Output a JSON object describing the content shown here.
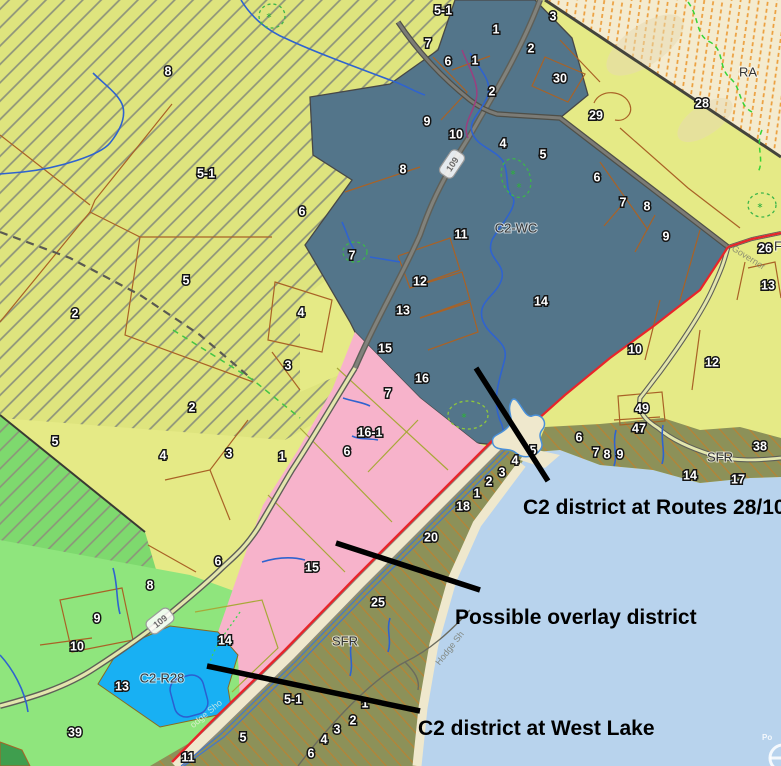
{
  "map": {
    "colors": {
      "yellow_flat": "#e5ea86",
      "yellow_hatch_bg": "#dee47e",
      "hatch_gray": "#8d937b",
      "slate": "#53758a",
      "pink": "#f7b3cb",
      "olive": "#8c9159",
      "olive_hatch": "#c07f2c",
      "ra_bg": "#f4ebcf",
      "ra_hatch": "#ec9f3d",
      "lake": "#b8d3ed",
      "cyan": "#18b0f3",
      "light_green": "#8fe57d",
      "green_hatch_bg": "#7ed96e",
      "sand": "#efe8cd",
      "road_red": "#e8252a",
      "stream_blue": "#2f63cf",
      "parcel_line": "#a96226",
      "pink_parcel_line": "#a8a838",
      "dark_green": "#3f9e4e",
      "annotation_black": "#000000"
    },
    "zone_labels": [
      {
        "t": "C2-WC",
        "x": 516,
        "y": 228,
        "s": 13
      },
      {
        "t": "RA",
        "x": 748,
        "y": 72,
        "s": 14
      },
      {
        "t": "SFR",
        "x": 345,
        "y": 641,
        "s": 13
      },
      {
        "t": "SFR",
        "x": 720,
        "y": 457,
        "s": 13
      },
      {
        "t": "C2-R28",
        "x": 162,
        "y": 678,
        "s": 13
      },
      {
        "t": "F",
        "x": 778,
        "y": 246,
        "s": 13
      }
    ],
    "parcel_labels": [
      {
        "t": "8",
        "x": 168,
        "y": 71
      },
      {
        "t": "5-1",
        "x": 443,
        "y": 10
      },
      {
        "t": "7",
        "x": 428,
        "y": 43
      },
      {
        "t": "3",
        "x": 553,
        "y": 16
      },
      {
        "t": "1",
        "x": 496,
        "y": 29
      },
      {
        "t": "2",
        "x": 531,
        "y": 48
      },
      {
        "t": "1",
        "x": 475,
        "y": 60
      },
      {
        "t": "6",
        "x": 448,
        "y": 61
      },
      {
        "t": "2",
        "x": 492,
        "y": 91
      },
      {
        "t": "30",
        "x": 560,
        "y": 78
      },
      {
        "t": "29",
        "x": 596,
        "y": 115
      },
      {
        "t": "28",
        "x": 702,
        "y": 103
      },
      {
        "t": "9",
        "x": 427,
        "y": 121
      },
      {
        "t": "10",
        "x": 456,
        "y": 134
      },
      {
        "t": "4",
        "x": 503,
        "y": 143
      },
      {
        "t": "5",
        "x": 543,
        "y": 154
      },
      {
        "t": "8",
        "x": 403,
        "y": 169
      },
      {
        "t": "6",
        "x": 597,
        "y": 177
      },
      {
        "t": "7",
        "x": 623,
        "y": 202
      },
      {
        "t": "8",
        "x": 647,
        "y": 206
      },
      {
        "t": "9",
        "x": 666,
        "y": 236
      },
      {
        "t": "11",
        "x": 461,
        "y": 234
      },
      {
        "t": "12",
        "x": 420,
        "y": 281
      },
      {
        "t": "13",
        "x": 403,
        "y": 310
      },
      {
        "t": "14",
        "x": 541,
        "y": 301
      },
      {
        "t": "15",
        "x": 385,
        "y": 348
      },
      {
        "t": "16",
        "x": 422,
        "y": 378
      },
      {
        "t": "5-1",
        "x": 206,
        "y": 173
      },
      {
        "t": "6",
        "x": 302,
        "y": 211
      },
      {
        "t": "7",
        "x": 352,
        "y": 255
      },
      {
        "t": "5",
        "x": 186,
        "y": 280
      },
      {
        "t": "2",
        "x": 75,
        "y": 313
      },
      {
        "t": "4",
        "x": 301,
        "y": 312
      },
      {
        "t": "3",
        "x": 288,
        "y": 365
      },
      {
        "t": "26",
        "x": 765,
        "y": 248
      },
      {
        "t": "13",
        "x": 768,
        "y": 285
      },
      {
        "t": "10",
        "x": 635,
        "y": 349
      },
      {
        "t": "12",
        "x": 712,
        "y": 362
      },
      {
        "t": "49",
        "x": 642,
        "y": 408
      },
      {
        "t": "47",
        "x": 639,
        "y": 428
      },
      {
        "t": "38",
        "x": 760,
        "y": 446
      },
      {
        "t": "14",
        "x": 690,
        "y": 475
      },
      {
        "t": "17",
        "x": 738,
        "y": 479
      },
      {
        "t": "6",
        "x": 579,
        "y": 437
      },
      {
        "t": "7",
        "x": 596,
        "y": 452
      },
      {
        "t": "8",
        "x": 607,
        "y": 454
      },
      {
        "t": "9",
        "x": 620,
        "y": 454
      },
      {
        "t": "5",
        "x": 533,
        "y": 450
      },
      {
        "t": "4",
        "x": 515,
        "y": 460
      },
      {
        "t": "3",
        "x": 502,
        "y": 472
      },
      {
        "t": "2",
        "x": 489,
        "y": 481
      },
      {
        "t": "1",
        "x": 477,
        "y": 493
      },
      {
        "t": "18",
        "x": 463,
        "y": 506
      },
      {
        "t": "20",
        "x": 431,
        "y": 537
      },
      {
        "t": "25",
        "x": 378,
        "y": 602
      },
      {
        "t": "5-1",
        "x": 293,
        "y": 699
      },
      {
        "t": "1",
        "x": 365,
        "y": 703
      },
      {
        "t": "2",
        "x": 353,
        "y": 720
      },
      {
        "t": "3",
        "x": 337,
        "y": 729
      },
      {
        "t": "4",
        "x": 324,
        "y": 739
      },
      {
        "t": "6",
        "x": 311,
        "y": 753
      },
      {
        "t": "5",
        "x": 243,
        "y": 737
      },
      {
        "t": "11",
        "x": 188,
        "y": 757
      },
      {
        "t": "1",
        "x": 282,
        "y": 456
      },
      {
        "t": "6",
        "x": 347,
        "y": 451
      },
      {
        "t": "7",
        "x": 388,
        "y": 393
      },
      {
        "t": "16-1",
        "x": 370,
        "y": 432
      },
      {
        "t": "15",
        "x": 312,
        "y": 567
      },
      {
        "t": "14",
        "x": 225,
        "y": 640
      },
      {
        "t": "2",
        "x": 192,
        "y": 407
      },
      {
        "t": "5",
        "x": 55,
        "y": 441
      },
      {
        "t": "4",
        "x": 163,
        "y": 455
      },
      {
        "t": "3",
        "x": 229,
        "y": 453
      },
      {
        "t": "6",
        "x": 218,
        "y": 561
      },
      {
        "t": "8",
        "x": 150,
        "y": 585
      },
      {
        "t": "9",
        "x": 97,
        "y": 618
      },
      {
        "t": "10",
        "x": 77,
        "y": 646
      },
      {
        "t": "13",
        "x": 122,
        "y": 686
      },
      {
        "t": "39",
        "x": 75,
        "y": 732
      }
    ],
    "annotations": [
      {
        "text": "C2 district at Routes 28/109",
        "x": 523,
        "y": 514,
        "line": [
          476,
          368,
          548,
          481
        ]
      },
      {
        "text": "Possible overlay district",
        "x": 455,
        "y": 624,
        "line": [
          336,
          543,
          480,
          590
        ]
      },
      {
        "text": "C2 district at West Lake",
        "x": 418,
        "y": 735,
        "line": [
          207,
          666,
          420,
          711
        ]
      }
    ],
    "road_shields": [
      {
        "text": "109",
        "x": 452,
        "y": 164,
        "angle": -56
      },
      {
        "text": "109",
        "x": 160,
        "y": 621,
        "angle": -38
      }
    ],
    "road_names": [
      {
        "text": "Governor",
        "x": 747,
        "y": 260,
        "angle": 32,
        "color": "#6f6f68"
      },
      {
        "text": "Hodge Sh",
        "x": 452,
        "y": 650,
        "angle": -52,
        "color": "#70705f"
      },
      {
        "text": "odge Sho",
        "x": 208,
        "y": 716,
        "angle": -40,
        "color": "#f2f2e4"
      }
    ],
    "watermark": {
      "text": "Po"
    }
  }
}
